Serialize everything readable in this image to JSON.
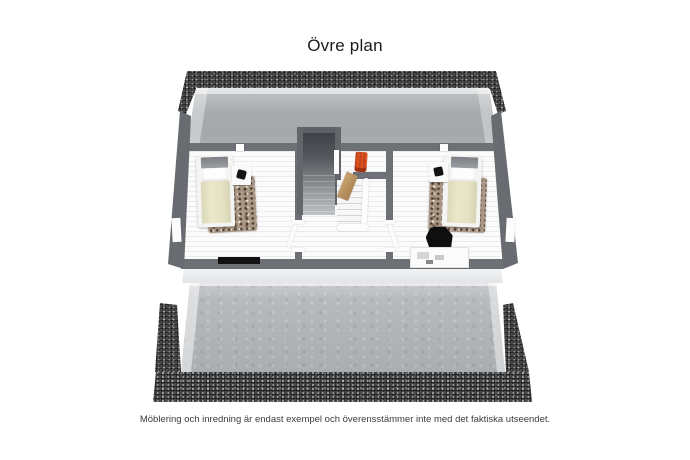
{
  "header": {
    "title": "Övre plan"
  },
  "footer": {
    "disclaimer": "Möblering och inredning är endast exempel och överensstämmer inte med det faktiska utseendet."
  },
  "floorplan": {
    "floor_label": "Övre plan",
    "view": "3d-top-down",
    "rooms": [
      {
        "name": "bedroom-left",
        "furniture": [
          "single-bed",
          "nightstand",
          "table-lamp",
          "rug",
          "black-bench"
        ]
      },
      {
        "name": "landing-hall",
        "furniture": [
          "staircase",
          "stair-railing",
          "accent-chair",
          "wood-door"
        ]
      },
      {
        "name": "bedroom-right",
        "furniture": [
          "single-bed",
          "nightstand",
          "table-lamp",
          "rug",
          "black-chair",
          "desk"
        ]
      }
    ],
    "colors": {
      "wall": "#6d7175",
      "roof_tiles": "#47494b",
      "attic_slope": "#a8acaf",
      "front_roof": "#b4b7ba",
      "floor": "#fbfbfb",
      "bed_duvet": "#eae7c9",
      "rug": "#ab9786",
      "accent_chair": "#d9531f",
      "door_wood": "#c9a36f"
    }
  }
}
